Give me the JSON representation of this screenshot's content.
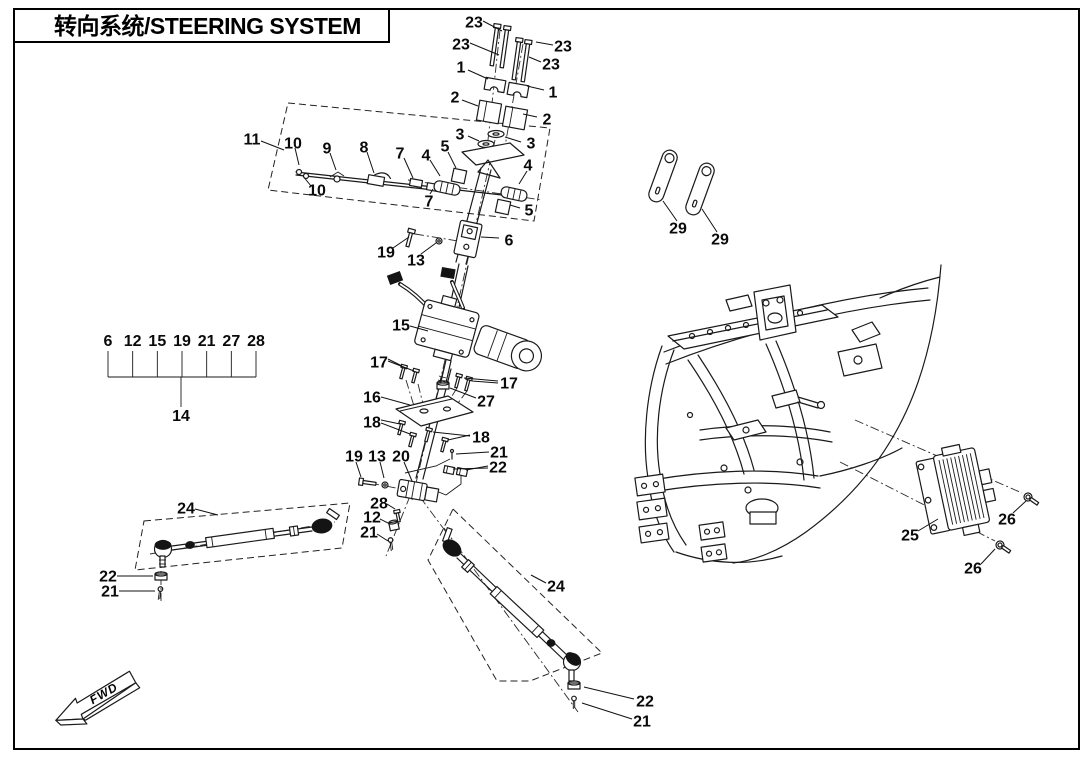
{
  "title": {
    "text": "转向系统/STEERING SYSTEM"
  },
  "fwd": {
    "label": "FWD"
  },
  "colors": {
    "ink": "#1a1a1a",
    "background": "#ffffff"
  },
  "legend": {
    "numbers": [
      "6",
      "12",
      "15",
      "19",
      "21",
      "27",
      "28"
    ],
    "assembly": "14",
    "x_start": 108,
    "x_end": 256,
    "y_numbers": 346,
    "y_bracket": 377,
    "stem_x": 181,
    "y_assembly": 421
  },
  "callouts": [
    {
      "n": "23",
      "x": 474,
      "y": 22,
      "leaders": [
        [
          [
            483,
            21
          ],
          [
            502,
            31
          ]
        ]
      ]
    },
    {
      "n": "23",
      "x": 461,
      "y": 44,
      "leaders": [
        [
          [
            470,
            43
          ],
          [
            499,
            55
          ]
        ]
      ]
    },
    {
      "n": "23",
      "x": 563,
      "y": 46,
      "leaders": [
        [
          [
            553,
            45
          ],
          [
            536,
            42
          ]
        ]
      ]
    },
    {
      "n": "23",
      "x": 551,
      "y": 64,
      "leaders": [
        [
          [
            541,
            62
          ],
          [
            529,
            57
          ]
        ]
      ]
    },
    {
      "n": "1",
      "x": 461,
      "y": 67,
      "leaders": [
        [
          [
            468,
            70
          ],
          [
            488,
            79
          ]
        ]
      ]
    },
    {
      "n": "1",
      "x": 553,
      "y": 92,
      "leaders": [
        [
          [
            544,
            90
          ],
          [
            527,
            86
          ]
        ]
      ]
    },
    {
      "n": "2",
      "x": 455,
      "y": 97,
      "leaders": [
        [
          [
            462,
            100
          ],
          [
            478,
            106
          ]
        ]
      ]
    },
    {
      "n": "2",
      "x": 547,
      "y": 119,
      "leaders": [
        [
          [
            537,
            117
          ],
          [
            523,
            114
          ]
        ]
      ]
    },
    {
      "n": "3",
      "x": 460,
      "y": 134,
      "leaders": [
        [
          [
            468,
            136
          ],
          [
            479,
            141
          ]
        ]
      ]
    },
    {
      "n": "3",
      "x": 531,
      "y": 143,
      "leaders": [
        [
          [
            521,
            142
          ],
          [
            505,
            137
          ]
        ]
      ]
    },
    {
      "n": "5",
      "x": 445,
      "y": 146,
      "leaders": [
        [
          [
            448,
            152
          ],
          [
            456,
            168
          ]
        ]
      ]
    },
    {
      "n": "4",
      "x": 426,
      "y": 155,
      "leaders": [
        [
          [
            430,
            160
          ],
          [
            440,
            176
          ]
        ]
      ]
    },
    {
      "n": "4",
      "x": 528,
      "y": 165,
      "leaders": [
        [
          [
            527,
            171
          ],
          [
            519,
            184
          ]
        ]
      ]
    },
    {
      "n": "5",
      "x": 529,
      "y": 210,
      "leaders": [
        [
          [
            520,
            208
          ],
          [
            510,
            205
          ]
        ]
      ]
    },
    {
      "n": "7",
      "x": 400,
      "y": 153,
      "leaders": [
        [
          [
            404,
            158
          ],
          [
            413,
            178
          ]
        ]
      ]
    },
    {
      "n": "7",
      "x": 429,
      "y": 201,
      "leaders": [
        [
          [
            430,
            194
          ],
          [
            433,
            189
          ]
        ]
      ]
    },
    {
      "n": "8",
      "x": 364,
      "y": 147,
      "leaders": [
        [
          [
            367,
            152
          ],
          [
            374,
            173
          ]
        ]
      ]
    },
    {
      "n": "9",
      "x": 327,
      "y": 148,
      "leaders": [
        [
          [
            330,
            153
          ],
          [
            336,
            170
          ]
        ]
      ]
    },
    {
      "n": "10",
      "x": 293,
      "y": 143,
      "leaders": [
        [
          [
            295,
            148
          ],
          [
            299,
            165
          ]
        ]
      ]
    },
    {
      "n": "10",
      "x": 317,
      "y": 190,
      "leaders": [
        [
          [
            311,
            186
          ],
          [
            303,
            176
          ]
        ]
      ]
    },
    {
      "n": "11",
      "x": 252,
      "y": 139,
      "leaders": [
        [
          [
            261,
            141
          ],
          [
            284,
            150
          ]
        ]
      ]
    },
    {
      "n": "19",
      "x": 386,
      "y": 252,
      "leaders": [
        [
          [
            393,
            248
          ],
          [
            409,
            237
          ]
        ]
      ]
    },
    {
      "n": "13",
      "x": 416,
      "y": 260,
      "leaders": [
        [
          [
            421,
            254
          ],
          [
            436,
            243
          ]
        ]
      ]
    },
    {
      "n": "6",
      "x": 509,
      "y": 240,
      "leaders": [
        [
          [
            499,
            238
          ],
          [
            481,
            237
          ]
        ]
      ]
    },
    {
      "n": "15",
      "x": 401,
      "y": 325,
      "leaders": [
        [
          [
            410,
            326
          ],
          [
            428,
            331
          ]
        ]
      ]
    },
    {
      "n": "17",
      "x": 379,
      "y": 362,
      "leaders": [
        [
          [
            388,
            359
          ],
          [
            402,
            366
          ]
        ],
        [
          [
            388,
            361
          ],
          [
            414,
            371
          ]
        ]
      ]
    },
    {
      "n": "16",
      "x": 372,
      "y": 397,
      "leaders": [
        [
          [
            381,
            397
          ],
          [
            410,
            405
          ]
        ]
      ]
    },
    {
      "n": "18",
      "x": 372,
      "y": 422,
      "leaders": [
        [
          [
            381,
            420
          ],
          [
            400,
            424
          ]
        ],
        [
          [
            381,
            423
          ],
          [
            410,
            434
          ]
        ]
      ]
    },
    {
      "n": "17",
      "x": 509,
      "y": 383,
      "leaders": [
        [
          [
            498,
            381
          ],
          [
            464,
            378
          ]
        ],
        [
          [
            498,
            383
          ],
          [
            472,
            381
          ]
        ]
      ]
    },
    {
      "n": "27",
      "x": 486,
      "y": 401,
      "leaders": [
        [
          [
            476,
            398
          ],
          [
            450,
            388
          ]
        ]
      ]
    },
    {
      "n": "18",
      "x": 481,
      "y": 437,
      "leaders": [
        [
          [
            470,
            435
          ],
          [
            448,
            440
          ]
        ],
        [
          [
            470,
            436
          ],
          [
            433,
            432
          ]
        ]
      ]
    },
    {
      "n": "19",
      "x": 354,
      "y": 456,
      "leaders": [
        [
          [
            356,
            462
          ],
          [
            361,
            477
          ]
        ]
      ]
    },
    {
      "n": "13",
      "x": 377,
      "y": 456,
      "leaders": [
        [
          [
            380,
            462
          ],
          [
            384,
            478
          ]
        ]
      ]
    },
    {
      "n": "20",
      "x": 401,
      "y": 456,
      "leaders": [
        [
          [
            404,
            462
          ],
          [
            412,
            481
          ]
        ]
      ]
    },
    {
      "n": "21",
      "x": 499,
      "y": 452,
      "leaders": [
        [
          [
            489,
            452
          ],
          [
            456,
            454
          ]
        ]
      ]
    },
    {
      "n": "22",
      "x": 498,
      "y": 467,
      "leaders": [
        [
          [
            488,
            466
          ],
          [
            466,
            470
          ]
        ],
        [
          [
            488,
            468
          ],
          [
            453,
            469
          ]
        ]
      ]
    },
    {
      "n": "28",
      "x": 379,
      "y": 503,
      "leaders": [
        [
          [
            387,
            504
          ],
          [
            395,
            509
          ]
        ]
      ]
    },
    {
      "n": "12",
      "x": 372,
      "y": 517,
      "leaders": [
        [
          [
            380,
            519
          ],
          [
            390,
            524
          ]
        ]
      ]
    },
    {
      "n": "21",
      "x": 369,
      "y": 532,
      "leaders": [
        [
          [
            377,
            534
          ],
          [
            388,
            541
          ]
        ]
      ]
    },
    {
      "n": "24",
      "x": 186,
      "y": 508,
      "leaders": [
        [
          [
            195,
            509
          ],
          [
            218,
            515
          ]
        ]
      ]
    },
    {
      "n": "22",
      "x": 108,
      "y": 576,
      "leaders": [
        [
          [
            117,
            576
          ],
          [
            153,
            576
          ]
        ]
      ]
    },
    {
      "n": "21",
      "x": 110,
      "y": 591,
      "leaders": [
        [
          [
            119,
            591
          ],
          [
            155,
            591
          ]
        ]
      ]
    },
    {
      "n": "24",
      "x": 556,
      "y": 586,
      "leaders": [
        [
          [
            546,
            583
          ],
          [
            531,
            575
          ]
        ]
      ]
    },
    {
      "n": "22",
      "x": 645,
      "y": 701,
      "leaders": [
        [
          [
            634,
            699
          ],
          [
            584,
            687
          ]
        ]
      ]
    },
    {
      "n": "21",
      "x": 642,
      "y": 721,
      "leaders": [
        [
          [
            632,
            719
          ],
          [
            582,
            703
          ]
        ]
      ]
    },
    {
      "n": "29",
      "x": 678,
      "y": 228,
      "leaders": [
        [
          [
            677,
            221
          ],
          [
            663,
            201
          ]
        ]
      ]
    },
    {
      "n": "29",
      "x": 720,
      "y": 239,
      "leaders": [
        [
          [
            717,
            232
          ],
          [
            702,
            209
          ]
        ]
      ]
    },
    {
      "n": "25",
      "x": 910,
      "y": 535,
      "leaders": [
        [
          [
            918,
            531
          ],
          [
            938,
            519
          ]
        ]
      ]
    },
    {
      "n": "26",
      "x": 1007,
      "y": 519,
      "leaders": [
        [
          [
            1013,
            513
          ],
          [
            1026,
            501
          ]
        ]
      ]
    },
    {
      "n": "26",
      "x": 973,
      "y": 568,
      "leaders": [
        [
          [
            981,
            564
          ],
          [
            995,
            549
          ]
        ]
      ]
    }
  ]
}
